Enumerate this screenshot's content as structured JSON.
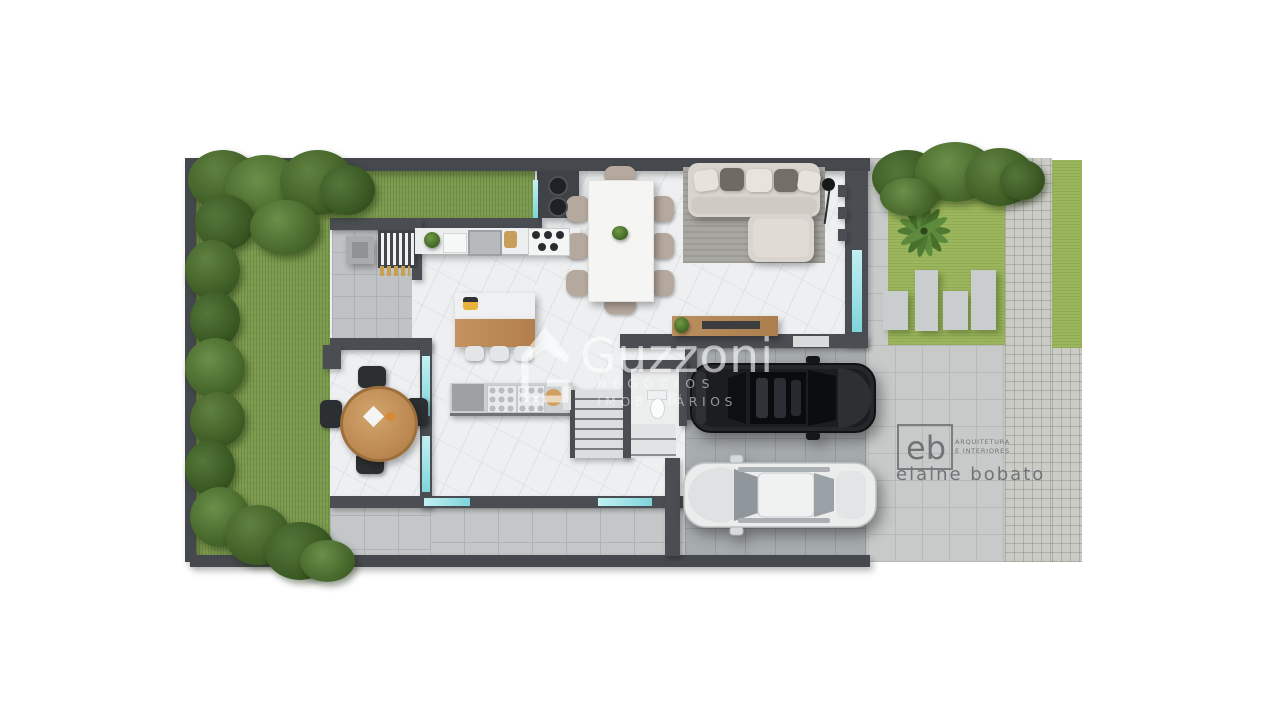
{
  "watermark": {
    "logo_icon": "house-g-icon",
    "brand": "Guzzoni",
    "tagline_line1": "NEGÓCIOS",
    "tagline_line2": "IMOBILIÁRIOS"
  },
  "architect_logo": {
    "initials": "eb",
    "studio_line1": "ARQUITETURA",
    "studio_line2": "E INTERIORES",
    "name": "elaine bobato"
  },
  "palette": {
    "background": "#ffffff",
    "wall_dark": "#45494d",
    "backyard_grass": "#7f9d51",
    "front_grass": "#9cb65e",
    "marble_floor": "#edeff1",
    "patio_tile": "#c4c7c8",
    "garage_floor": "#a7acae",
    "driveway_tile": "#c7cac9",
    "paver": "#cbccc6",
    "glass_window": "#7fd4da",
    "sofa_fabric": "#d9d5ce",
    "wood": "#c4935f",
    "suv_body": "#26272a",
    "sedan_body": "#ebecec"
  }
}
